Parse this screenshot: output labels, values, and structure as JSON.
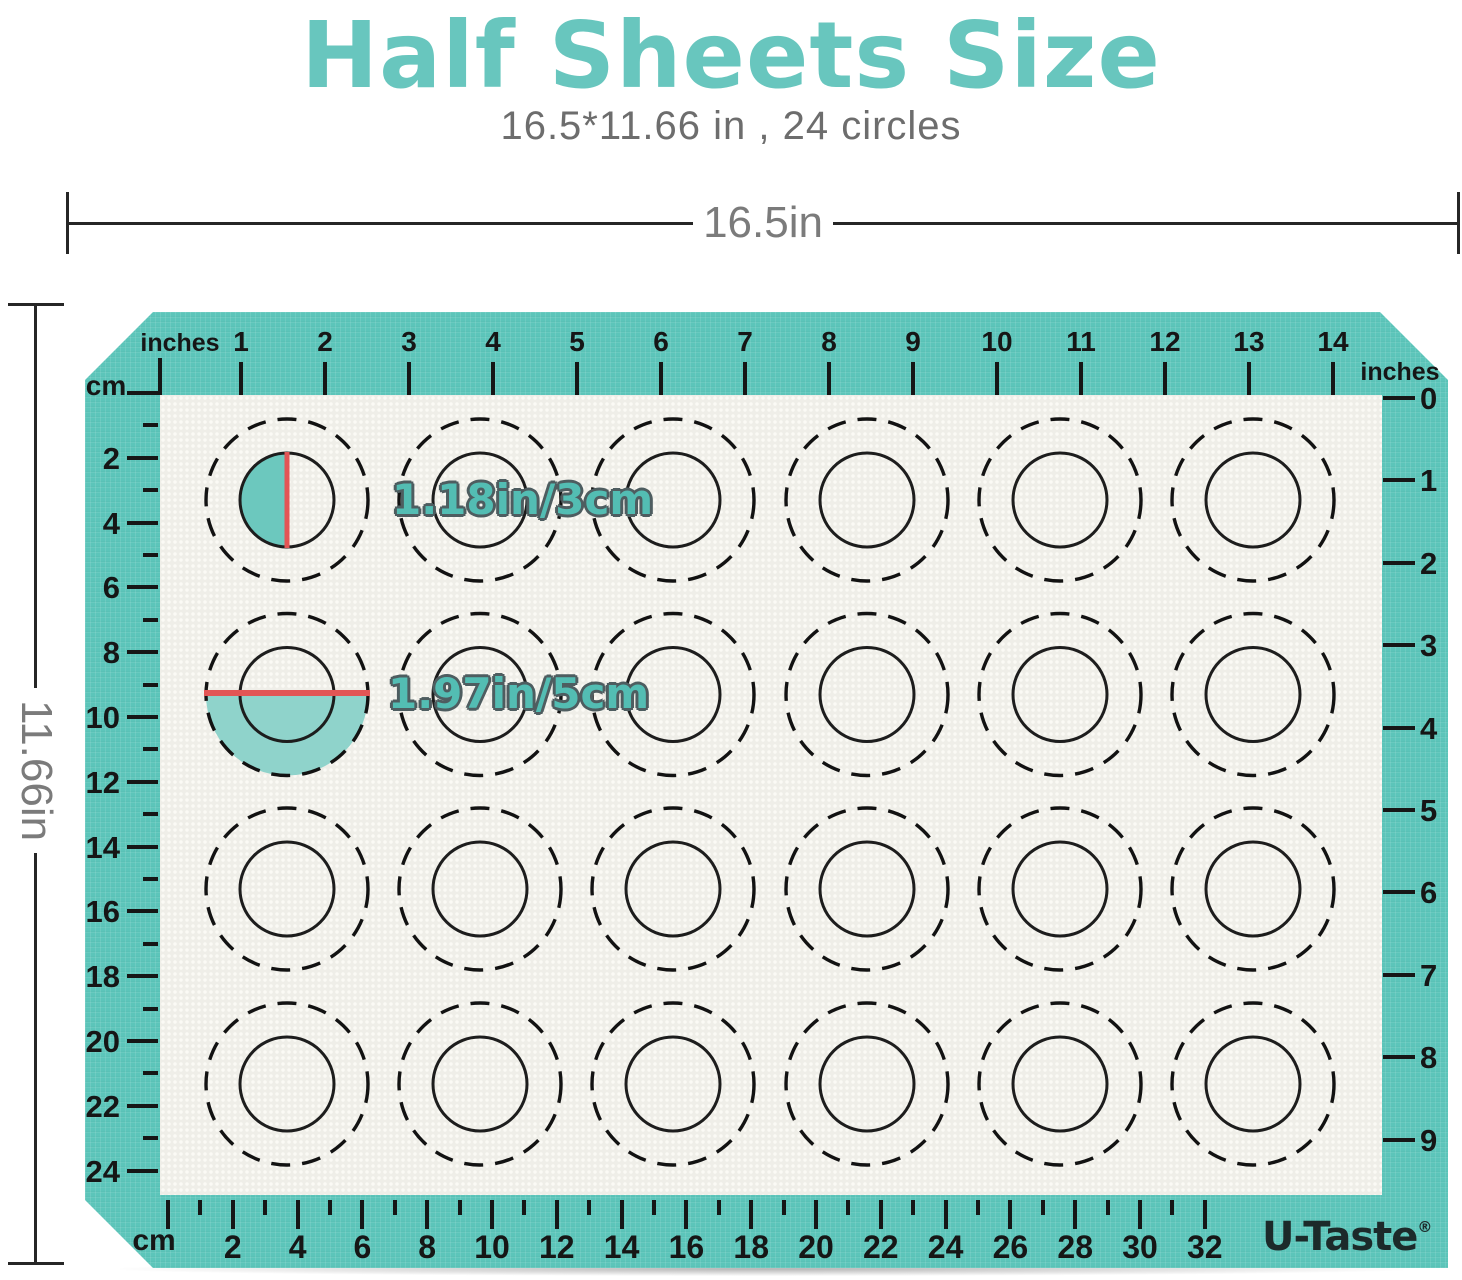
{
  "header": {
    "title": "Half Sheets Size",
    "subtitle": "16.5*11.66 in , 24 circles"
  },
  "dimension_labels": {
    "width": "16.5in",
    "height": "11.66in"
  },
  "rulers": {
    "top": {
      "unit": "inches",
      "numbers": [
        1,
        2,
        3,
        4,
        5,
        6,
        7,
        8,
        9,
        10,
        11,
        12,
        13,
        14
      ]
    },
    "left": {
      "unit": "cm",
      "numbers": [
        2,
        4,
        6,
        8,
        10,
        12,
        14,
        16,
        18,
        20,
        22,
        24
      ]
    },
    "right": {
      "unit": "inches",
      "numbers": [
        0,
        1,
        2,
        3,
        4,
        5,
        6,
        7,
        8,
        9
      ]
    },
    "bottom": {
      "unit": "cm",
      "numbers": [
        2,
        4,
        6,
        8,
        10,
        12,
        14,
        16,
        18,
        20,
        22,
        24,
        26,
        28,
        30,
        32
      ]
    }
  },
  "annotations": {
    "small_circle": "1.18in/3cm",
    "large_circle": "1.97in/5cm"
  },
  "logo": {
    "text": "U-Taste",
    "reg": "®"
  },
  "grid": {
    "rows": 4,
    "cols": 6,
    "circle_count": 24
  },
  "colors": {
    "mat_teal": "#5cc5ba",
    "surface": "#efeee8",
    "accent_red": "#e25555",
    "annotation_fill": "#53bdb3",
    "annotation_outline": "#4e5d60",
    "half_fill_small": "#6cc8be",
    "half_fill_large": "#8fd3cb",
    "ink": "#161616",
    "dim_gray": "#7b7b7b",
    "title_teal": "#68c6be",
    "logo_ink": "#1c2a2a"
  }
}
